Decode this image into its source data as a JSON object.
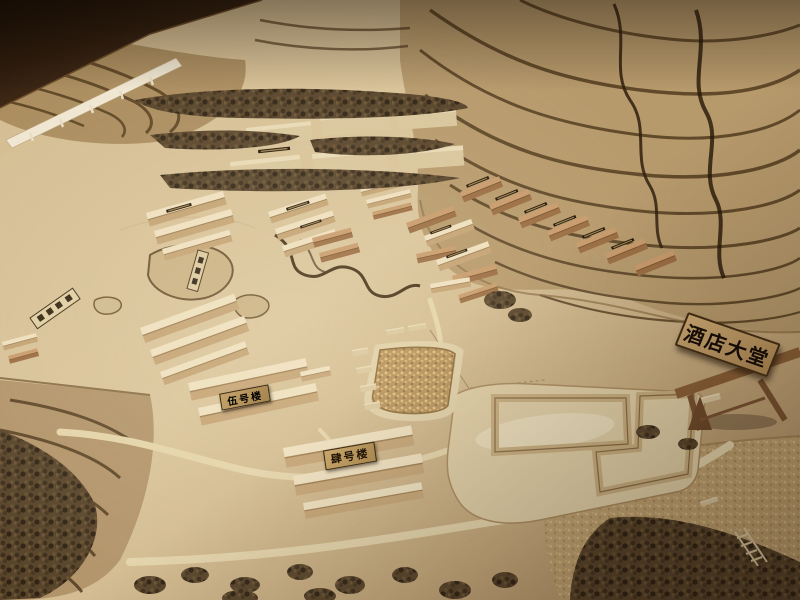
{
  "scene": {
    "description": "Photograph of a wooden architectural scale model (sand table) of a hillside resort masterplan: terraced contour hills, tree rows, clusters of gabled model buildings with small roof plaques, winding stream, ponds, crop field, roads, an unfinished hotel pad, and a gateway sign",
    "signs": {
      "hotel_lobby": "酒店大堂",
      "building_no5": "伍号楼",
      "building_no4": "肆号楼"
    },
    "palette": {
      "table_wood_dark": "#1b0f05",
      "baseboard_tan": "#d3bb90",
      "contour_dark_brown": "#4e3819",
      "building_cream": "#eee0bf",
      "building_shadow": "#c3a273",
      "cork_brown": "#b98a5c",
      "foliage_dark": "#3c2d1a",
      "sign_board_gold": "#bb9a68",
      "sign_text_black": "#150d05",
      "road_cream": "#e4d4ab"
    }
  }
}
